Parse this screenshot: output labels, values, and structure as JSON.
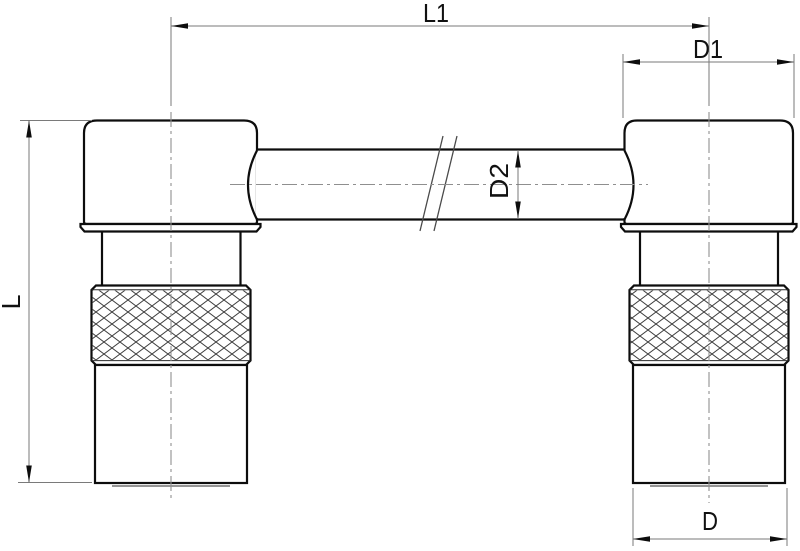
{
  "drawing": {
    "labels": {
      "overall_length": "L1",
      "head_width": "D1",
      "tube_diameter": "D2",
      "overall_height": "L",
      "body_diameter": "D"
    },
    "colors": {
      "background": "#ffffff",
      "outline": "#0d0d0d",
      "thin_edge": "#2b2b2b",
      "hatch": "#3f3f3f",
      "break_line": "#4a4a4a",
      "dimension_line": "#7a7a7a",
      "centerline": "#8f8f8f",
      "text": "#111111"
    }
  }
}
